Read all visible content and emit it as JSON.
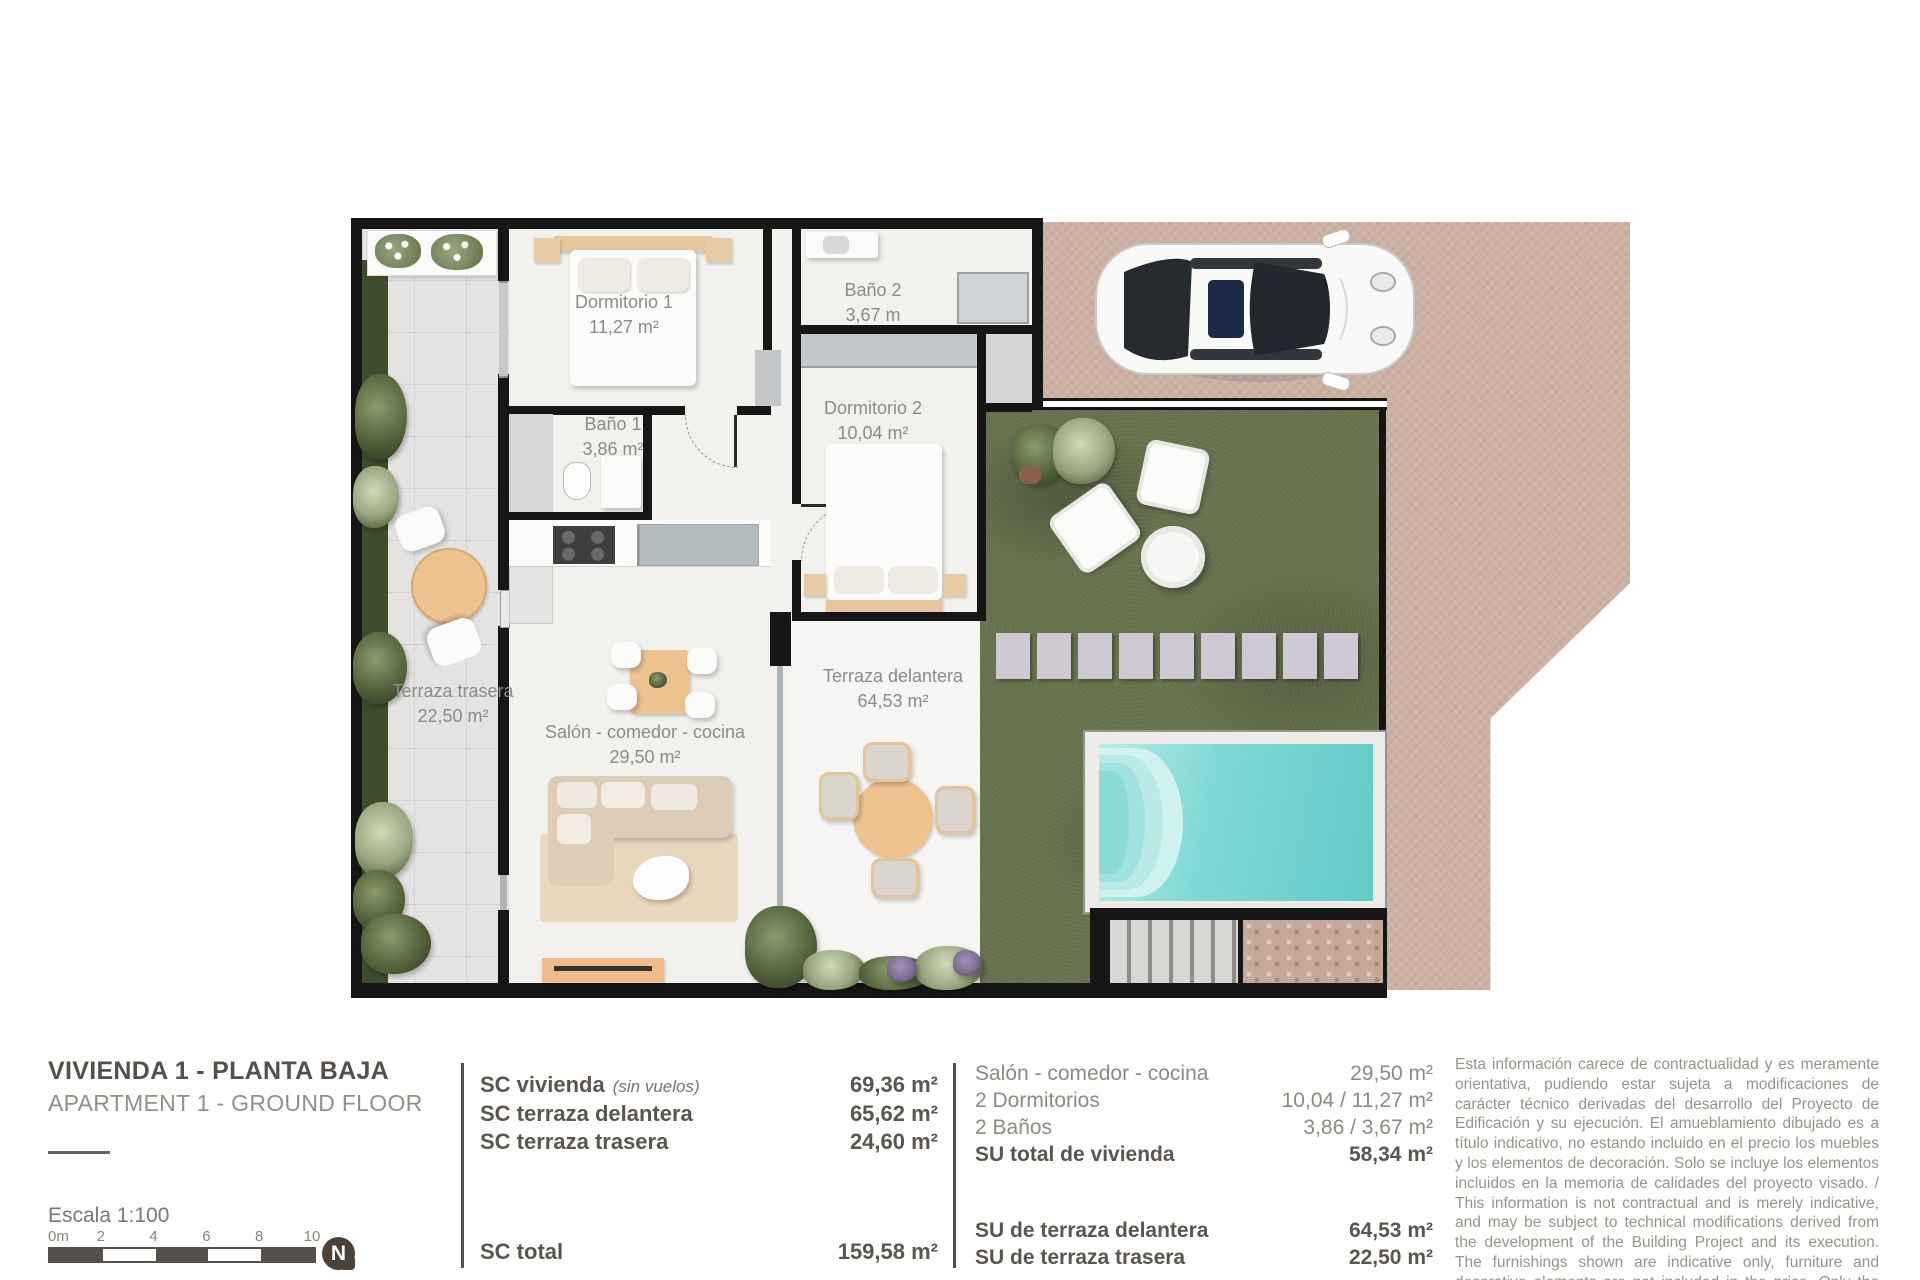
{
  "title": {
    "main": "VIVIENDA 1 - PLANTA BAJA",
    "sub": "APARTMENT 1 - GROUND FLOOR"
  },
  "scale": {
    "label": "Escala  1:100",
    "ticks": [
      "0m",
      "2",
      "4",
      "6",
      "8",
      "10"
    ],
    "north_letter": "N"
  },
  "plan": {
    "rooms": [
      {
        "name": "Dormitorio 1",
        "area": "11,27 m²"
      },
      {
        "name": "Baño 2",
        "area": "3,67 m"
      },
      {
        "name": "Baño 1",
        "area": "3,86 m²"
      },
      {
        "name": "Dormitorio 2",
        "area": "10,04 m²"
      },
      {
        "name": "Terraza trasera",
        "area": "22,50 m²"
      },
      {
        "name": "Salón - comedor - cocina",
        "area": "29,50 m²"
      },
      {
        "name": "Terraza delantera",
        "area": "64,53 m²"
      }
    ]
  },
  "sc_table": {
    "rows": [
      {
        "label": "SC vivienda",
        "note": "(sin vuelos)",
        "value": "69,36 m²"
      },
      {
        "label": "SC terraza delantera",
        "note": "",
        "value": "65,62 m²"
      },
      {
        "label": "SC terraza trasera",
        "note": "",
        "value": "24,60 m²"
      }
    ],
    "total": {
      "label": "SC total",
      "value": "159,58 m²"
    }
  },
  "su_table": {
    "rows": [
      {
        "label": "Salón - comedor - cocina",
        "value": "29,50 m²"
      },
      {
        "label": "2 Dormitorios",
        "value": "10,04 / 11,27 m²"
      },
      {
        "label": "2 Baños",
        "value": "3,86 / 3,67 m²"
      },
      {
        "label": "SU total de vivienda",
        "value": "58,34 m²"
      }
    ],
    "terraces": [
      {
        "label": "SU de terraza delantera",
        "value": "64,53 m²"
      },
      {
        "label": "SU de terraza trasera",
        "value": "22,50 m²"
      }
    ]
  },
  "disclaimer": {
    "text": "Esta información carece de contractualidad y es meramente orientativa, pudiendo estar sujeta a modificaciones de carácter técnico derivadas del desarrollo del Proyecto de Edificación y su ejecución. El amueblamiento dibujado es a título indicativo, no estando incluido en el precio los muebles y los elementos de decoración. Solo se incluye los elementos incluidos en la memoria de calidades del proyecto visado. / This information is not contractual and is merely indicative, and may be subject to technical modifications derived from the development of the Building Project and its execution. The furnishings shown are indicative only, furniture and decorative elements are not included in the price. Only the elements included in the quality specifications of the approved project are included."
  },
  "colors": {
    "wall": "#161616",
    "ink": "#56504a",
    "ink-light": "#948e84",
    "paving": "#ccb0a2",
    "garden": "#66714d",
    "pool": "#7fd8d3",
    "tile": "#e4e3e1",
    "wood": "#edc28f"
  }
}
